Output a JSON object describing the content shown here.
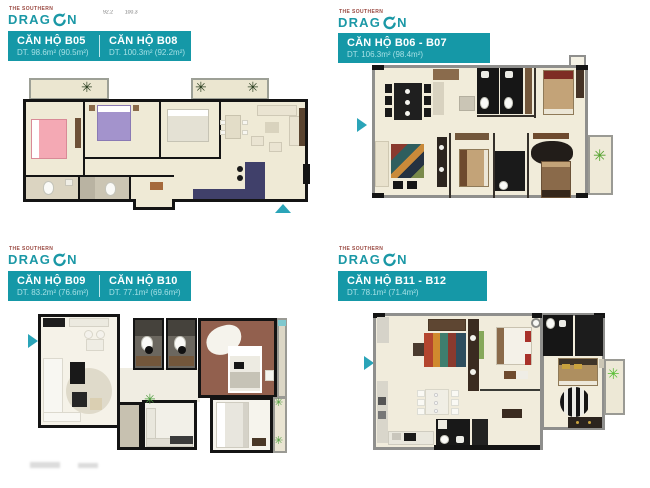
{
  "colors": {
    "accent": "#1598a7",
    "accent_light": "#a5e0e5",
    "arrow": "#2aa4b8",
    "logo_teal": "#1b98a6",
    "logo_tagline": "#9a4a42"
  },
  "icons": {
    "plant": "✳"
  },
  "logo": {
    "tagline": "THE SOUTHERN",
    "word_start": "DRAG",
    "word_end": "N"
  },
  "top_note": {
    "left": "92.2",
    "right": "100.3"
  },
  "panels": [
    {
      "id": "b05-b08",
      "units": [
        {
          "name": "CĂN HỘ B05",
          "area": "DT. 98.6m² (90.5m²)"
        },
        {
          "name": "CĂN HỘ B08",
          "area": "DT. 100.3m² (92.2m²)"
        }
      ]
    },
    {
      "id": "b06-b07",
      "units": [
        {
          "name": "CĂN HỘ B06 - B07",
          "area": "DT. 106.3m² (98.4m²)"
        }
      ]
    },
    {
      "id": "b09-b10",
      "units": [
        {
          "name": "CĂN HỘ B09",
          "area": "DT. 83.2m² (76.6m²)"
        },
        {
          "name": "CĂN HỘ B10",
          "area": "DT. 77.1m² (69.6m²)"
        }
      ]
    },
    {
      "id": "b11-b12",
      "units": [
        {
          "name": "CĂN HỘ B11 - B12",
          "area": "DT. 78.1m² (71.4m²)"
        }
      ]
    }
  ]
}
